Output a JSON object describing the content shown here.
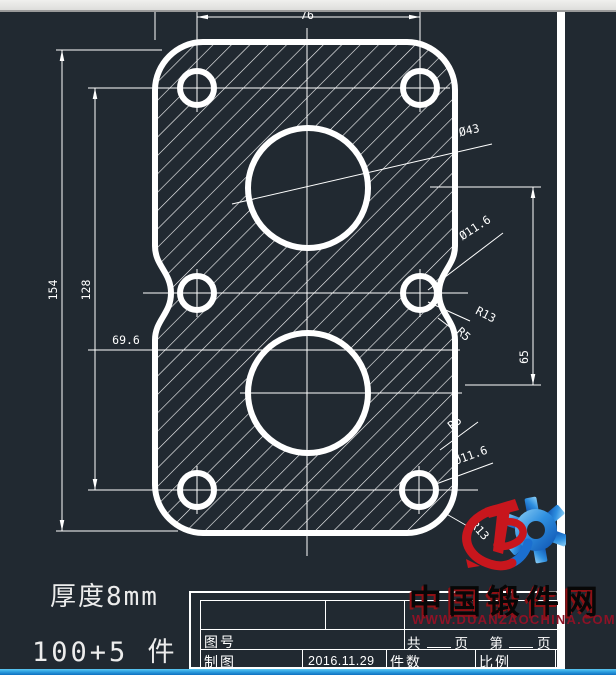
{
  "drawing": {
    "dimensions": {
      "top_width": "76",
      "overall_height": "154",
      "hole_span_height": "128",
      "offset_left": "69.6",
      "circle_spacing": "65",
      "big_circle_dia": "Ø43",
      "side_hole_dia": "Ø11.6",
      "side_corner_radius": "R13",
      "side_fillet_radius": "R5",
      "bottom_fillet_radius": "R5",
      "bottom_hole_dia": "Ø11.6",
      "bottom_corner_radius": "R13"
    },
    "notes": {
      "thickness": "厚度8mm",
      "quantity": "100+5 件"
    }
  },
  "title_block": {
    "drawing_no_label": "图号",
    "drafter_label": "制图",
    "date": "2016.11.29",
    "quantity_label": "件数",
    "scale_label": "比例",
    "pages": {
      "total": "共",
      "page": "页",
      "no": "第",
      "page2": "页"
    }
  },
  "watermark": {
    "site_name": "中国锻件网",
    "site_url": "WWW.DUANZAOCHINA.COM"
  },
  "colors": {
    "canvas_bg": "#212931",
    "line": "#ffffff",
    "logo_red": "#c8161d",
    "logo_blue": "#1b6fd0",
    "url_red": "#8e1226",
    "taskbar_blue": "#2da0e0",
    "topbar_gray": "#e6e6e4"
  }
}
